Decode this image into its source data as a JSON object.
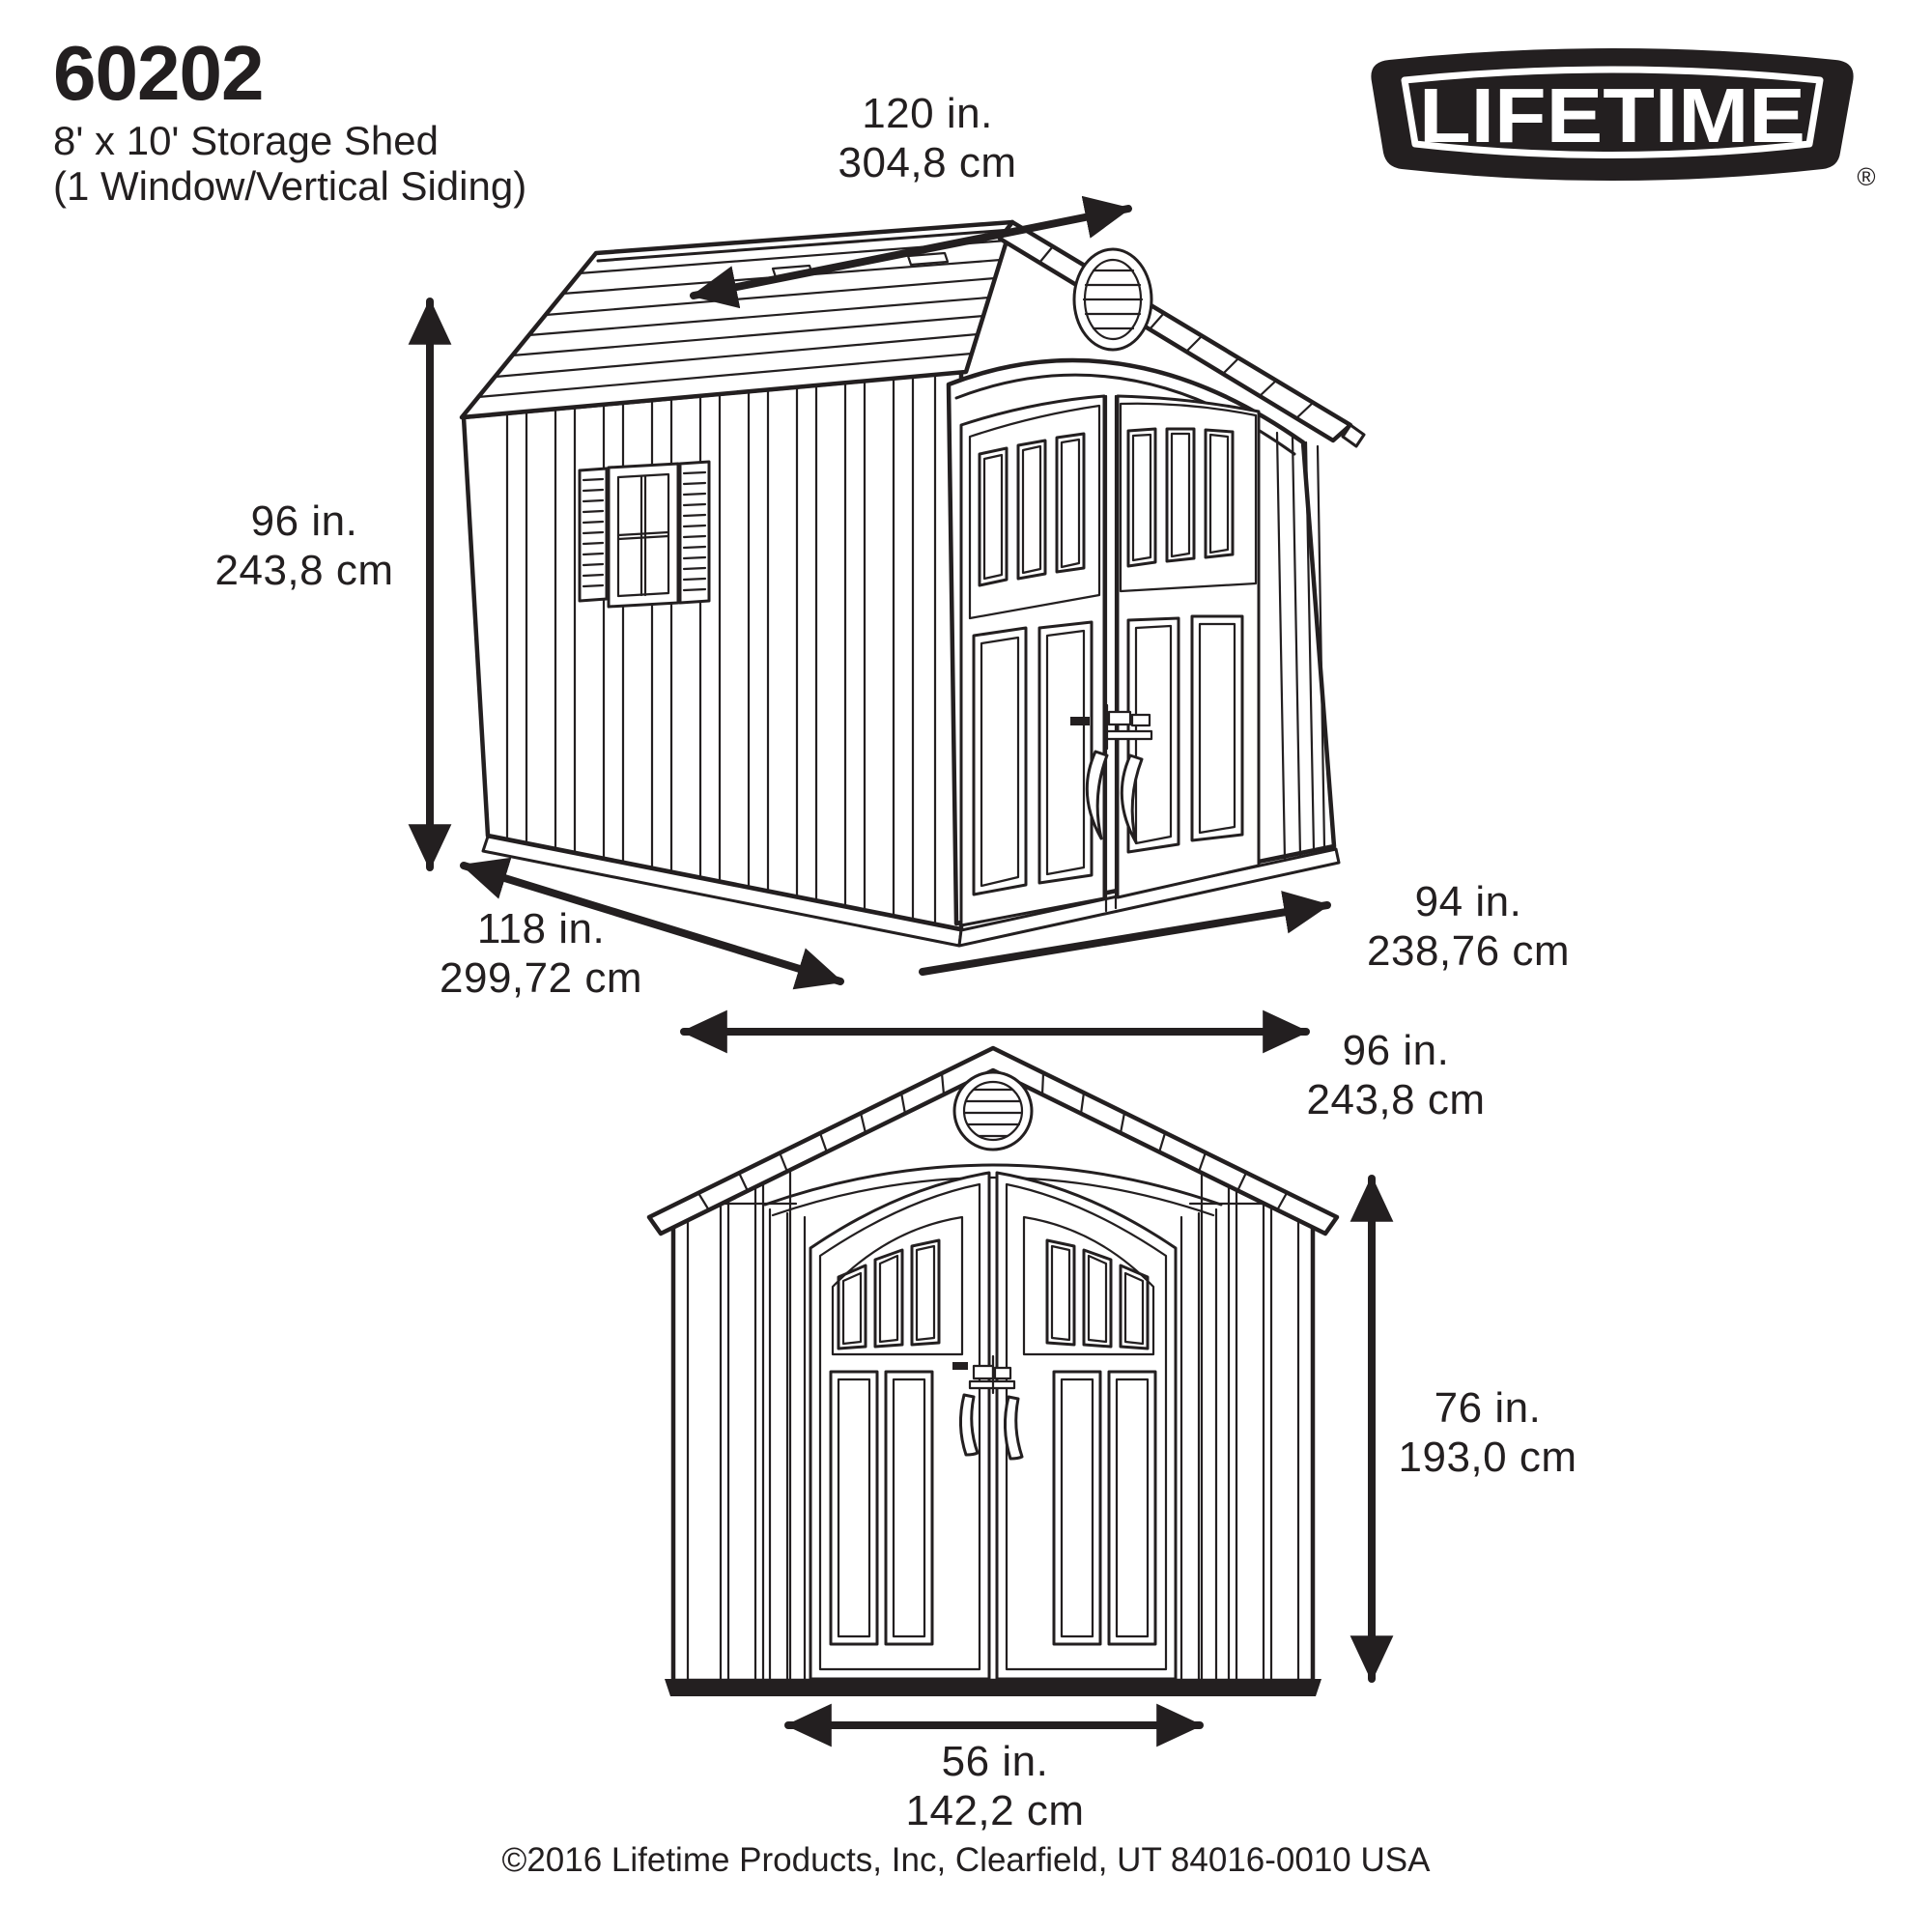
{
  "header": {
    "model_number": "60202",
    "product_name": "8' x 10' Storage Shed",
    "product_variant": "(1 Window/Vertical Siding)"
  },
  "brand": {
    "logo_text": "LIFETIME",
    "registered_mark": "®"
  },
  "dimensions": {
    "roof_length": {
      "inches": "120 in.",
      "metric": "304,8 cm"
    },
    "wall_height": {
      "inches": "96 in.",
      "metric": "243,8 cm"
    },
    "depth": {
      "inches": "118 in.",
      "metric": "299,72 cm"
    },
    "front_width": {
      "inches": "94 in.",
      "metric": "238,76 cm"
    },
    "overall_width": {
      "inches": "96 in.",
      "metric": "243,8 cm"
    },
    "door_height": {
      "inches": "76 in.",
      "metric": "193,0 cm"
    },
    "door_width": {
      "inches": "56 in.",
      "metric": "142,2 cm"
    }
  },
  "footer": {
    "copyright": "©2016 Lifetime Products, Inc, Clearfield, UT 84016-0010 USA"
  },
  "colors": {
    "line": "#231f20",
    "background": "#ffffff"
  }
}
